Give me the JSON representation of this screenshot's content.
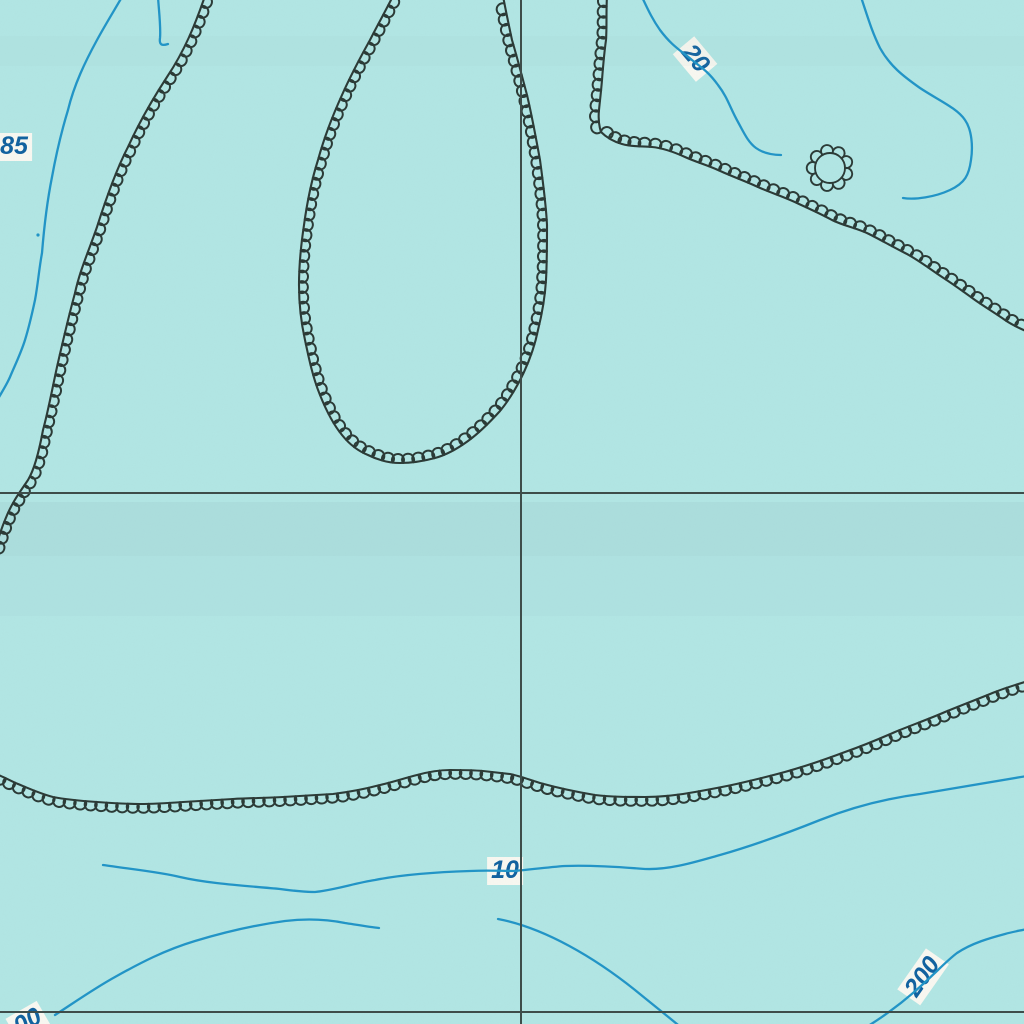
{
  "map": {
    "type": "bathymetric-topographic-map",
    "background_color": "#b2e6e4",
    "grain_opacity": 0.05,
    "bands": [
      {
        "name": "scan-shade-band-1",
        "x": 0,
        "y": 502,
        "w": 1024,
        "h": 54,
        "color": "#8fb4ba",
        "opacity": 0.16
      },
      {
        "name": "scan-shade-band-2",
        "x": 0,
        "y": 556,
        "w": 1024,
        "h": 60,
        "color": "#8fb4ba",
        "opacity": 0.07
      },
      {
        "name": "scan-shade-band-3",
        "x": 0,
        "y": 36,
        "w": 1024,
        "h": 30,
        "color": "#8fb4ba",
        "opacity": 0.05
      }
    ],
    "grid": {
      "color": "#3e4d4a",
      "width": 1.7,
      "vertical_x": 521,
      "horizontal_y1": 493,
      "horizontal_y2": 1012
    },
    "blue_style": {
      "color": "#2294c6",
      "width": 2.3
    },
    "blue_contours": [
      {
        "name": "stream-line-85",
        "d": "M 122,-3 C 112,14 104,27 97,40 C 85,62 74,85 68,110 C 61,133 56,155 52,177 C 47,202 44,228 42,253 C 39,269 38,284 35,300 C 32,314 29,327 25,340 C 21,353 15,365 10,377 C 7,384 3,390 -2,399"
      },
      {
        "name": "stream-branch-top",
        "d": "M 158,-3 C 159,12 161,28 160,38 C 159,45 162,46 168,44"
      },
      {
        "name": "contour-line-20",
        "d": "M 642,-3 C 649,12 653,20 660,30 C 672,46 680,50 692,60 C 705,70 710,74 718,85 C 728,98 730,108 738,122 C 744,133 748,142 756,148 C 763,153 772,155 781,155"
      },
      {
        "name": "contour-line-topright",
        "d": "M 861,-3 C 868,18 872,32 880,48 C 890,66 903,76 920,88 C 938,100 957,108 965,120 C 972,130 973,147 971,160 C 969,175 965,183 950,190 C 935,197 915,200 903,198"
      },
      {
        "name": "contour-line-10",
        "d": "M 103,865 C 130,869 160,872 180,877 C 210,884 250,886 280,889 C 295,891 305,892 315,892 C 335,890 355,883 375,880 C 405,874 440,872 470,871 C 490,870 500,871 515,871 C 535,869 550,867 565,866 C 590,865 620,867 645,869 C 670,870 695,862 720,855 C 755,845 790,832 820,820 C 855,806 890,798 920,794 C 955,788 990,782 1027,776"
      },
      {
        "name": "contour-line-200-left",
        "d": "M 55,1015 C 75,1002 95,988 115,977 C 140,963 165,950 195,941 C 225,932 255,925 285,921 C 310,918 330,920 345,923 C 358,925 370,927 379,928"
      },
      {
        "name": "contour-line-200-mid",
        "d": "M 498,919 C 545,928 595,958 635,990 C 662,1012 680,1026 696,1040"
      },
      {
        "name": "contour-line-200-right",
        "d": "M 858,1032 C 872,1024 892,1011 913,993 C 935,974 945,962 957,953 C 972,943 990,938 1005,934 C 1012,932 1018,931 1027,929"
      }
    ],
    "blue_dots": [
      {
        "name": "blue-speck",
        "cx": 38,
        "cy": 235,
        "r": 1.6
      }
    ],
    "hachure_style": {
      "color": "#2c3b37",
      "width": 2.1,
      "spacing": 10.5,
      "loop_radius_factor": 0.57
    },
    "hachured_contours": [
      {
        "name": "depression-contour-west",
        "sweep": 1,
        "d": "M 205,-4 C 195,25 185,50 167,77 C 150,103 138,125 128,147 C 115,172 104,205 97,227 C 88,253 80,270 75,293 C 69,315 62,345 57,367 C 52,390 48,412 43,430 C 39,452 34,470 28,480 C 20,492 12,502 5,520 C 0,532 -2,540 -6,552"
      },
      {
        "name": "depression-contour-loop",
        "sweep": 1,
        "d": "M 393,-4 C 385,12 377,26 370,40 C 360,58 350,77 342,95 C 332,117 324,138 318,160 C 311,182 307,203 304,225 C 301,245 299,265 299,285 C 299,304 301,322 305,340 C 309,359 313,378 320,395 C 326,410 333,424 342,435 C 350,445 358,451 368,455 C 378,460 389,463 400,463 C 412,463 424,461 435,458 C 446,455 457,449 468,441 C 479,433 490,422 500,411 C 509,400 517,387 524,372 C 530,359 535,345 538,330 C 542,314 545,297 546,280 C 547,262 547,243 547,225 C 546,204 543,182 540,160 C 536,138 532,116 527,95 C 522,76 517,57 512,40 C 509,26 506,12 503,-4"
      },
      {
        "name": "depression-contour-northeast-vertical",
        "sweep": 0,
        "d": "M 607,-4 C 606,12 607,26 606,40 C 604,54 603,67 602,80 C 601,92 600,100 599,110 C 598,120 599,126 601,132"
      },
      {
        "name": "depression-contour-northeast",
        "sweep": 1,
        "d": "M 601,132 C 608,139 615,142 622,144 C 632,147 642,146 652,147 C 663,148 674,152 685,157 C 696,162 707,165 718,170 C 731,176 745,181 758,187 C 771,193 785,197 799,204 C 810,209 821,214 832,220 C 844,226 857,228 869,234 C 881,240 893,247 905,253 C 917,259 930,269 942,277 C 953,284 964,292 975,300 C 985,307 995,313 1005,320 C 1012,325 1019,328 1028,332"
      },
      {
        "name": "depression-contour-south",
        "sweep": 0,
        "d": "M -4,774 C 4,777 11,781 18,784 C 30,789 41,794 53,797 C 68,800 82,801 97,802 C 111,803 126,804 140,804 C 154,804 169,803 183,802 C 200,801 216,800 233,799 C 250,798 266,798 283,797 C 300,796 316,795 333,794 C 349,792 365,789 380,785 C 393,782 405,778 417,775 C 428,772 439,770 450,770 C 461,770 472,770 483,771 C 492,772 501,773 510,774 C 520,776 530,780 540,783 C 558,788 577,792 595,795 C 612,797 628,797 645,797 C 662,797 679,795 695,792 C 712,789 729,786 745,782 C 762,778 779,774 795,769 C 812,764 829,758 845,752 C 862,746 879,739 895,732 C 912,725 929,719 945,712 C 962,705 978,699 995,692 C 1005,688 1015,685 1028,681"
      }
    ],
    "rosette": {
      "name": "closed-depression-rosette",
      "cx": 830,
      "cy": 168,
      "r": 15,
      "loops": 9
    },
    "label_style": {
      "bg": "#f9f8f1",
      "fg": "#11619f"
    },
    "labels": [
      {
        "id": "contour-label-85",
        "text": "85",
        "x": 14,
        "y": 147,
        "rotation": 0
      },
      {
        "id": "contour-label-20",
        "text": "20",
        "x": 695,
        "y": 59,
        "rotation": 50
      },
      {
        "id": "contour-label-10",
        "text": "10",
        "x": 505,
        "y": 871,
        "rotation": 0
      },
      {
        "id": "contour-label-200",
        "text": "200",
        "x": 923,
        "y": 977,
        "rotation": -55
      },
      {
        "id": "contour-label-00",
        "text": "00",
        "x": 28,
        "y": 1022,
        "rotation": -30
      }
    ]
  }
}
